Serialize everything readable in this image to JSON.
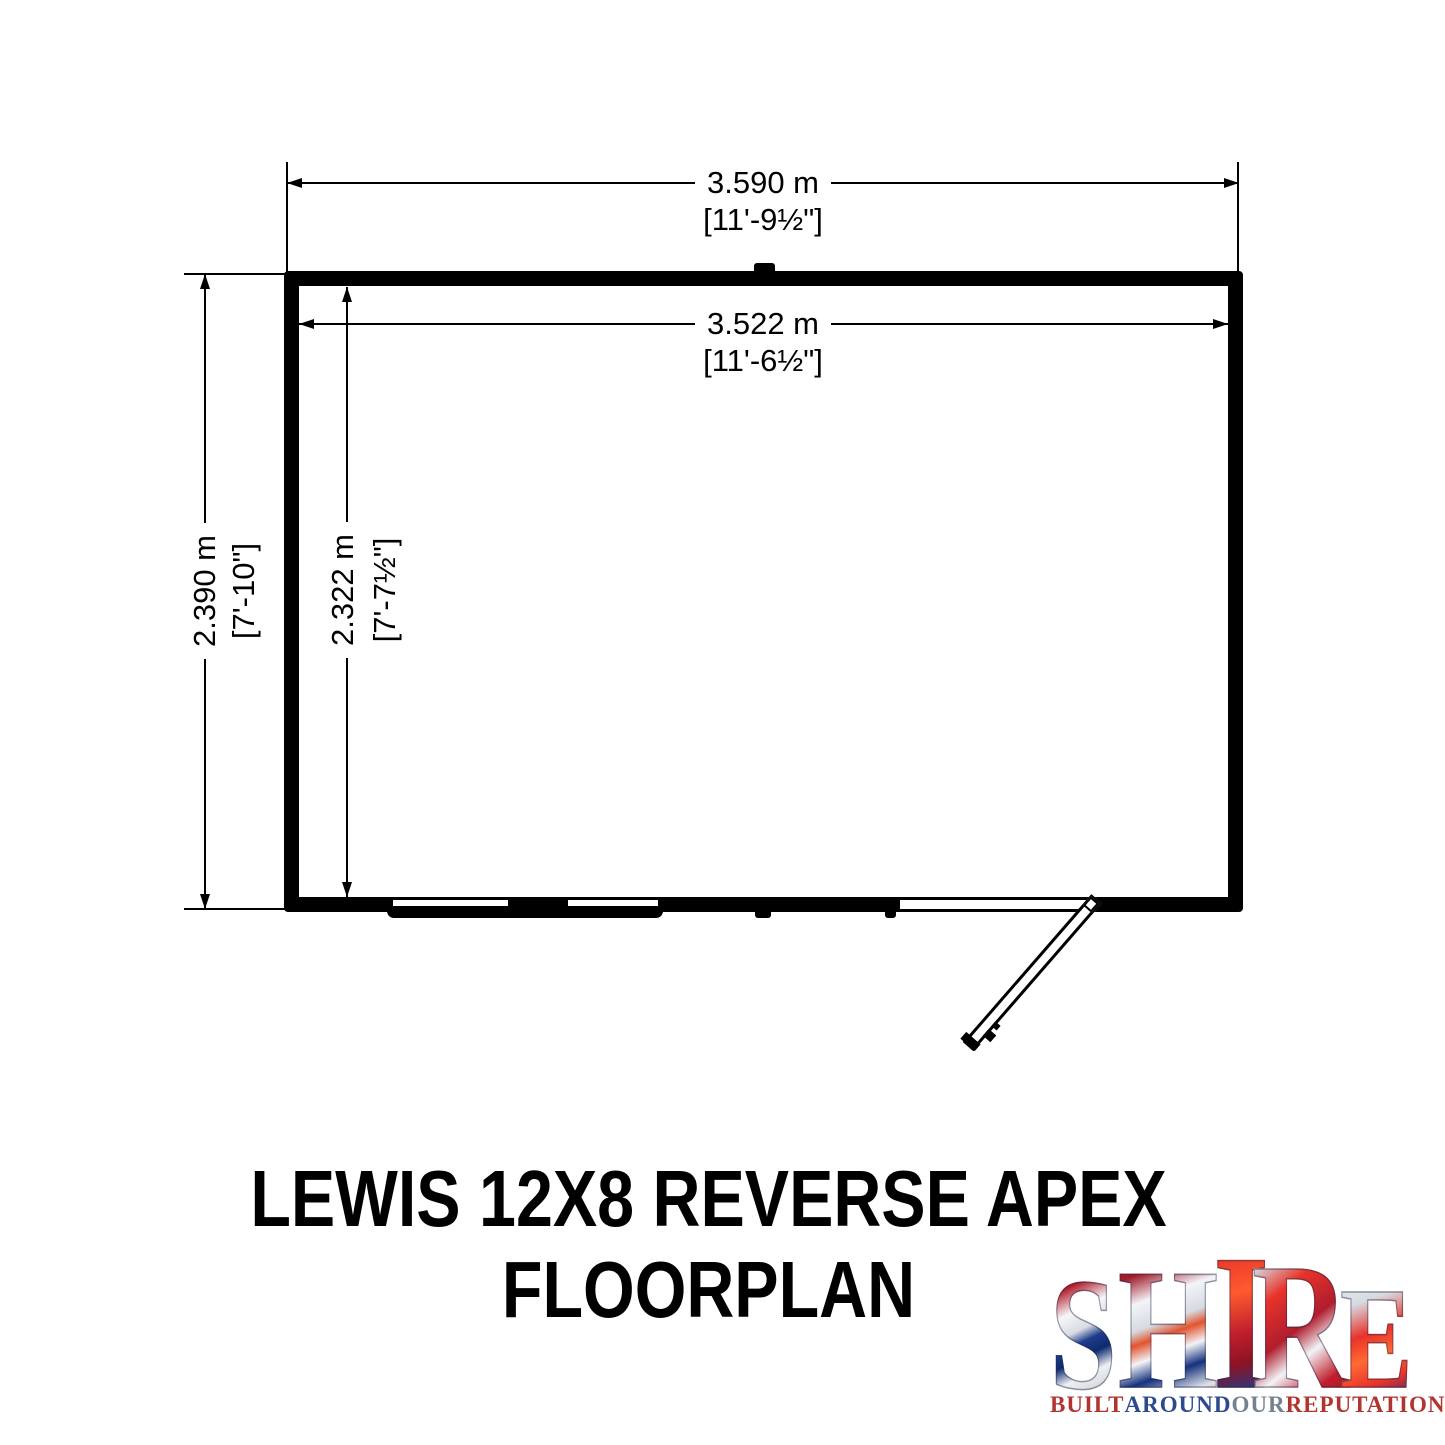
{
  "title": {
    "line1": "LEWIS 12X8 REVERSE APEX",
    "line2": "FLOORPLAN"
  },
  "dimensions": {
    "width_overall": {
      "metric": "3.590 m",
      "imperial": "[11'-9½\"]"
    },
    "width_internal": {
      "metric": "3.522 m",
      "imperial": "[11'-6½\"]"
    },
    "depth_overall": {
      "metric": "2.390 m",
      "imperial": "[7'-10\"]"
    },
    "depth_internal": {
      "metric": "2.322 m",
      "imperial": "[7'-7½\"]"
    }
  },
  "floorplan": {
    "features": [
      "apex-ridge-marker",
      "double-front-window",
      "front-right-hinged-door"
    ],
    "wall_color": "#000000",
    "background_color": "#ffffff"
  },
  "logo": {
    "letters": [
      {
        "char": "S"
      },
      {
        "char": "H"
      },
      {
        "char": "I"
      },
      {
        "char": "R"
      },
      {
        "char": "E"
      }
    ],
    "tagline": [
      {
        "text": "BUILT"
      },
      {
        "text": "AROUND"
      },
      {
        "text": "OUR"
      },
      {
        "text": "REPUTATION"
      }
    ],
    "colors": {
      "flag_red": "#c01f2c",
      "flag_blue": "#15317e",
      "flag_silver": "#e8ebef",
      "tagline_red": "#b23430",
      "tagline_blue": "#2e4a8f",
      "tagline_gray": "#74818f"
    }
  }
}
